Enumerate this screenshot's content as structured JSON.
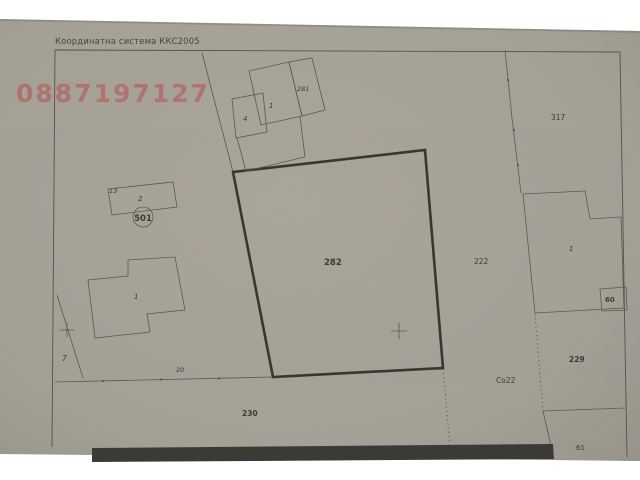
{
  "document": {
    "coordinate_system_label": "Координатна система ККС2005",
    "watermark_phone": "0887197127"
  },
  "map": {
    "parcels": {
      "central": "282",
      "top_right": "317",
      "right_mid": "222",
      "right_lower": "229",
      "bottom_strip": "230",
      "bottom_right": "61",
      "left_small": "7",
      "circled_point": "501",
      "edge_point": "13",
      "road_width": "20",
      "soil_code": "Со22"
    },
    "buildings": {
      "left_house": "1",
      "small_rect_house": "2",
      "top_garage": "4",
      "top_house": "1",
      "top_wing": "281",
      "right_house": "1",
      "right_annex": "60"
    },
    "colors": {
      "paper": "#b3aea3",
      "line": "#57524a",
      "bold_outline": "#3a362e",
      "watermark": "#b64f4c",
      "redaction_bar": "#3b3a36"
    }
  }
}
